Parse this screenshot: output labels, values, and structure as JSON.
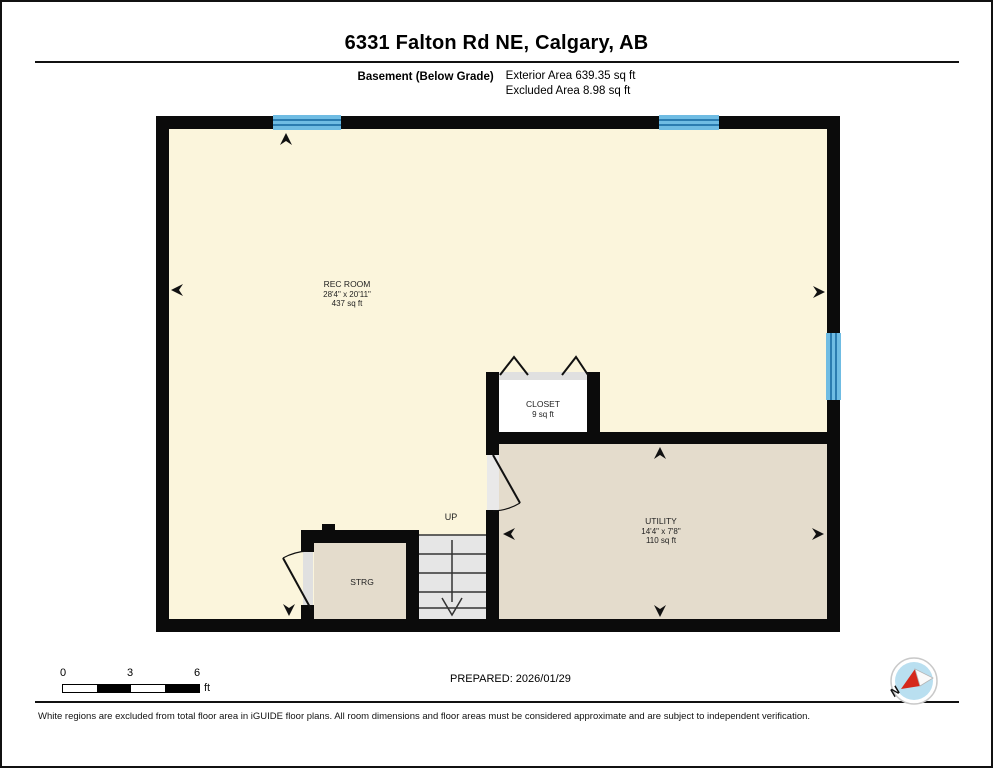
{
  "page": {
    "title": "6331 Falton Rd NE, Calgary, AB",
    "floor_label": "Basement (Below Grade)",
    "exterior_area": "Exterior Area 639.35 sq ft",
    "excluded_area": "Excluded Area 8.98 sq ft",
    "prepared": "PREPARED: 2026/01/29",
    "disclaimer": "White regions are excluded from total floor area in iGUIDE floor plans. All room dimensions and floor areas must be considered approximate and are subject to independent verification."
  },
  "rooms": {
    "rec_room": {
      "name": "REC ROOM",
      "dims": "28'4\" x 20'11\"",
      "area": "437 sq ft"
    },
    "closet": {
      "name": "CLOSET",
      "area": "9 sq ft"
    },
    "utility": {
      "name": "UTILITY",
      "dims": "14'4\" x 7'8\"",
      "area": "110 sq ft"
    },
    "storage": {
      "name": "STRG"
    },
    "stairs": {
      "label": "UP"
    }
  },
  "scale_bar": {
    "ticks": [
      "0",
      "3",
      "6"
    ],
    "unit": "ft"
  },
  "compass": {
    "label": "N"
  },
  "colors": {
    "floor_cream": "#FBF5DC",
    "floor_tan": "#E4DCCC",
    "closet_white": "#FFFFFF",
    "stairs_gray": "#E6E6E6",
    "door_track_gray": "#E0E0E0",
    "window_blue": "#6FBCE3",
    "window_blue_dark": "#2B7CB0",
    "wall_black": "#0B0B0B",
    "compass_blue": "#B9DFF0",
    "compass_red": "#D5281B"
  }
}
